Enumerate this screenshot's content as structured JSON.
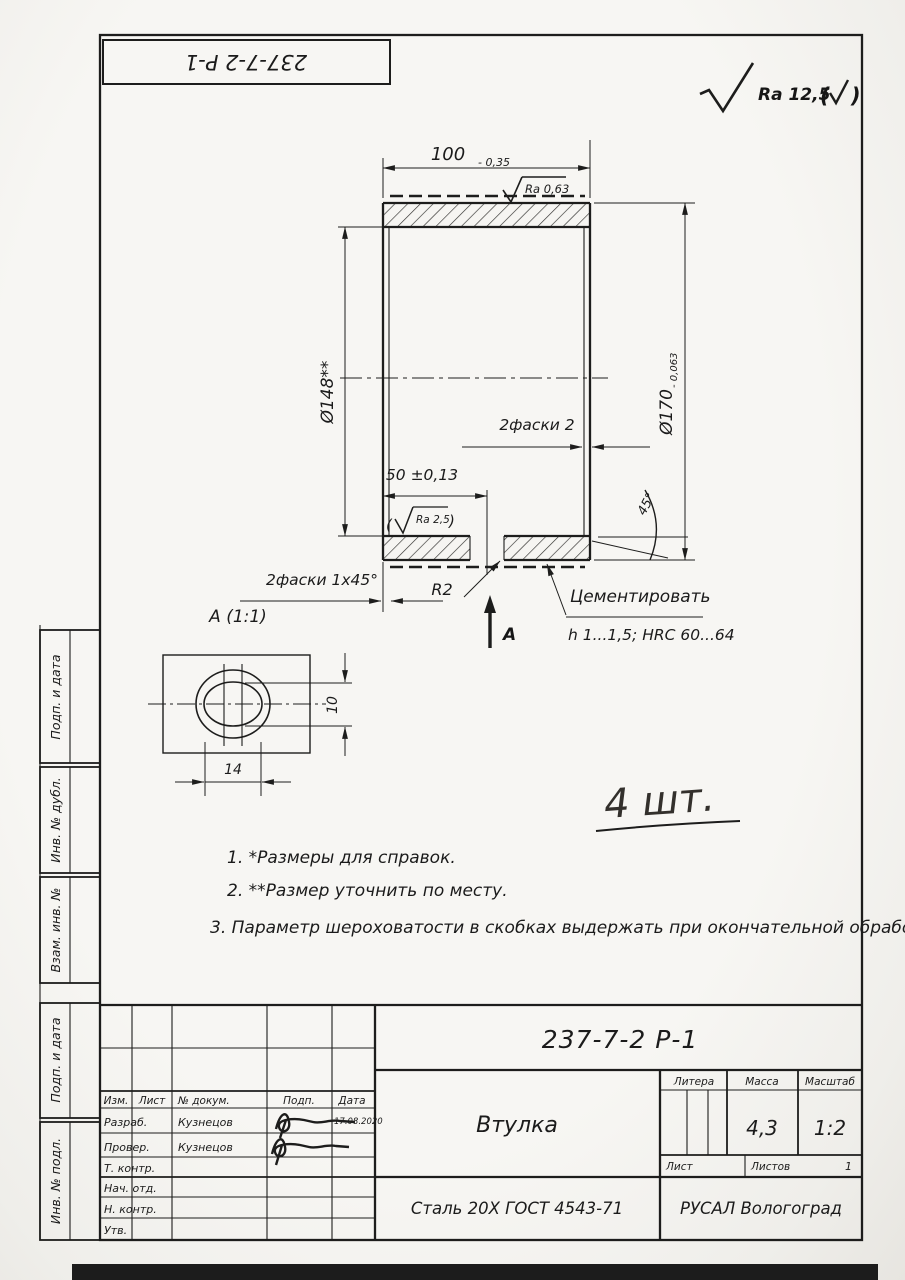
{
  "colors": {
    "paper": "#f6f5f2",
    "ink": "#1d1d1c",
    "hatch": "#30302e"
  },
  "header": {
    "flipped_title": "237-7-2 Р-1",
    "surface_finish": "Ra 12,5",
    "paren_open": "(",
    "paren_close": ")"
  },
  "main_view": {
    "dim_length": "100",
    "dim_length_tol": "- 0,35",
    "ra_top": "Ra 0,63",
    "dim_inner": "Ø148**",
    "dim_outer": "Ø170",
    "dim_outer_tol": "- 0,063",
    "chamfer_right": "2фаски 2",
    "dim_slot_pos": "50 ±0,13",
    "ra_bore_open": "(",
    "ra_bore": "Ra 2,5",
    "ra_bore_close": ")",
    "chamfer_left": "2фаски 1x45°",
    "radius": "R2",
    "section_arrow_label": "А",
    "angle": "45°",
    "treatment_line1": "Цементировать",
    "treatment_line2": "h 1...1,5; HRC 60...64"
  },
  "detail_view": {
    "title": "А (1:1)",
    "dim_width": "14",
    "dim_height": "10"
  },
  "quantity_note": "4 шт.",
  "notes": [
    "1. *Размеры для справок.",
    "2. **Размер уточнить по месту.",
    "3. Параметр шероховатости в скобках выдержать при окончательной обработке."
  ],
  "side_labels": [
    "Подп. и дата",
    "Инв. № дубл.",
    "Взам. инв. №",
    "Подп. и дата",
    "Инв. № подл."
  ],
  "title_block": {
    "designation": "237-7-2 Р-1",
    "part_name": "Втулка",
    "material": "Сталь 20Х ГОСТ 4543-71",
    "company": "РУСАЛ Вологоград",
    "litera_label": "Литера",
    "mass_label": "Масса",
    "scale_label": "Масштаб",
    "mass": "4,3",
    "scale": "1:2",
    "sheet_label": "Лист",
    "sheets_label": "Листов",
    "sheets_value": "1",
    "columns": [
      "Изм.",
      "Лист",
      "№ докум.",
      "Подп.",
      "Дата"
    ],
    "rows": [
      {
        "role": "Разраб.",
        "name": "Кузнецов",
        "date": "17.08.2020"
      },
      {
        "role": "Провер.",
        "name": "Кузнецов",
        "date": ""
      },
      {
        "role": "Т. контр.",
        "name": "",
        "date": ""
      },
      {
        "role": "Нач. отд.",
        "name": "",
        "date": ""
      },
      {
        "role": "Н. контр.",
        "name": "",
        "date": ""
      },
      {
        "role": "Утв.",
        "name": "",
        "date": ""
      }
    ]
  }
}
